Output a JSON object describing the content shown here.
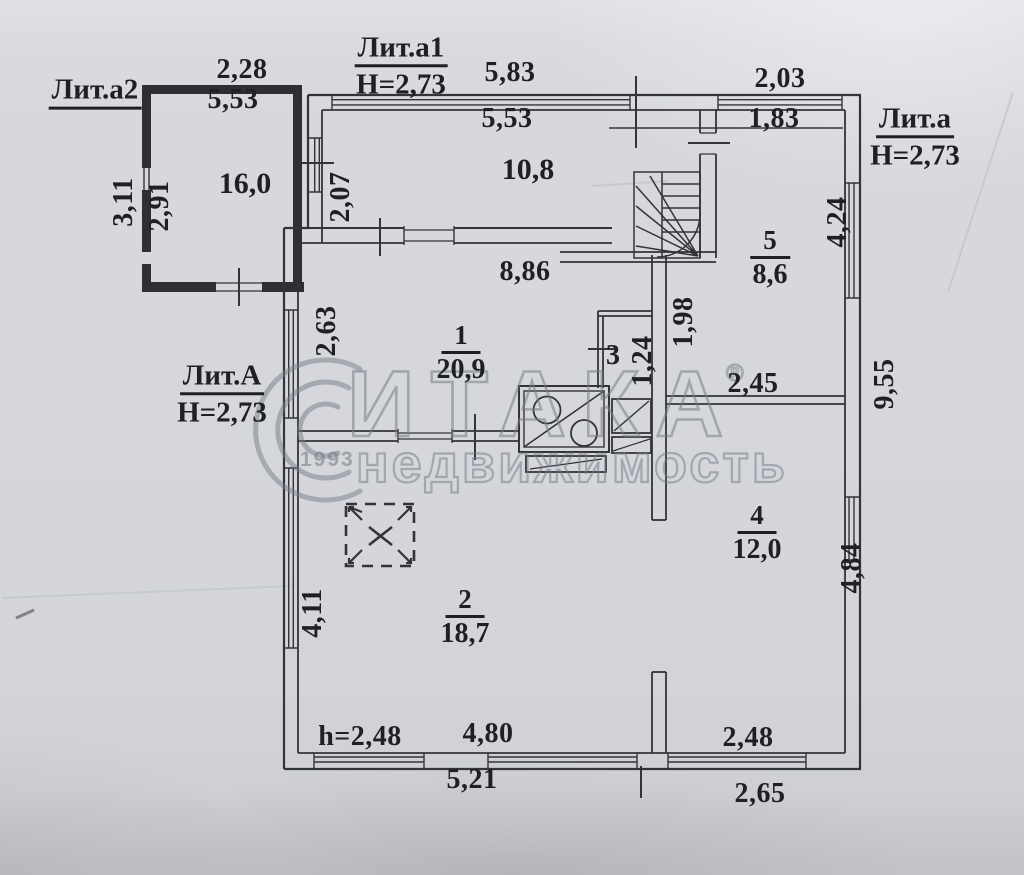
{
  "colors": {
    "paper": "#d6d8dd",
    "ink": "#1f2026",
    "watermark_gray": "#787b84"
  },
  "watermark": {
    "brand": "ИТАКА",
    "reg": "®",
    "subtitle": "недвижимость",
    "year": "1993"
  },
  "annex_a2": {
    "label": "Лит.а2",
    "area": "16,0",
    "dim_width_outer": "2,28",
    "dim_width_inner": "5,53",
    "dim_height_outer": "3,11",
    "dim_height_inner": "2,91"
  },
  "veranda_a1": {
    "label": "Лит.а1",
    "ceiling_height": "Н=2,73",
    "dim_width_outer": "5,83",
    "dim_width_inner": "5,53",
    "area": "10,8",
    "dim_left": "2,07"
  },
  "porch_a": {
    "label": "Лит.а",
    "ceiling_height": "Н=2,73",
    "dim_width_outer": "2,03",
    "dim_width_inner": "1,83",
    "dim_right_upper": "4,24"
  },
  "main_A": {
    "label": "Лит.А",
    "ceiling_height": "Н=2,73"
  },
  "rooms": {
    "r1": {
      "number": "1",
      "area": "20,9"
    },
    "r2": {
      "number": "2",
      "area": "18,7"
    },
    "r3": {
      "number": "3"
    },
    "r4": {
      "number": "4",
      "area": "12,0"
    },
    "r5": {
      "number": "5",
      "area": "8,6"
    }
  },
  "dimensions": {
    "d886": "8,86",
    "d263": "2,63",
    "d198": "1,98",
    "d124": "1,24",
    "d245": "2,45",
    "d955": "9,55",
    "d484": "4,84",
    "d411": "4,11",
    "h248": "h=2,48",
    "d480": "4,80",
    "d248": "2,48",
    "d521": "5,21",
    "d265": "2,65"
  }
}
